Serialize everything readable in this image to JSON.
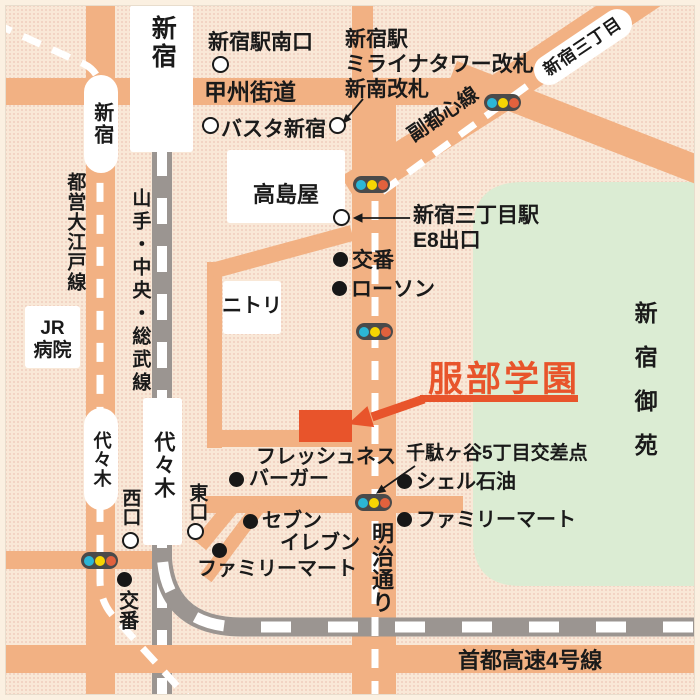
{
  "colors": {
    "background": "#f9e8d7",
    "road": "#f2b183",
    "green_area": "#dbecd3",
    "railway_gray": "#9b9591",
    "accent_red": "#e8542b",
    "traffic_light_body": "#4a4a4a",
    "traffic_light_blue": "#2cb6d6",
    "traffic_light_yellow": "#f6d503",
    "traffic_light_red": "#e2613d"
  },
  "destination": {
    "name": "服部学園"
  },
  "roads": {
    "koshu_kaido": "甲州街道",
    "meiji_dori": "明治通り",
    "shuto_expressway": "首都高速4号線"
  },
  "railways": {
    "toei_oedo_line": "都営大江戸線",
    "yamanote_chuo_sobu_line": "山手・中央・総武線",
    "fukutoshin_line": "副都心線"
  },
  "stations": {
    "shinjuku_jr": "新宿",
    "shinjuku_oedo": "新宿",
    "yoyogi_jr": "代々木",
    "yoyogi_oedo": "代々木",
    "shinjuku_sanchome": "新宿三丁目",
    "exits": {
      "shinjuku_south": "新宿駅南口",
      "basuta": "バスタ新宿",
      "miraina_line1": "新宿駅",
      "miraina_line2": "ミライナタワー改札",
      "miraina_line3": "新南改札",
      "sanchome_station_line1": "新宿三丁目駅",
      "sanchome_station_line2": "E8出口",
      "nishi": "西口",
      "higashi": "東口"
    }
  },
  "landmarks": {
    "takashimaya": "高島屋",
    "nitori": "ニトリ",
    "jr_hospital_line1": "JR",
    "jr_hospital_line2": "病院",
    "koban_upper": "交番",
    "lawson": "ローソン",
    "freshness_burger_line1": "フレッシュネス",
    "freshness_burger_line2": "バーガー",
    "seven_eleven_line1": "セブン",
    "seven_eleven_line2": "イレブン",
    "familymart_left": "ファミリーマート",
    "familymart_right": "ファミリーマート",
    "shell_oil": "シェル石油",
    "koban_lower": "交番",
    "shinjuku_gyoen": "新宿御苑",
    "sendagaya_intersection": "千駄ヶ谷5丁目交差点"
  }
}
